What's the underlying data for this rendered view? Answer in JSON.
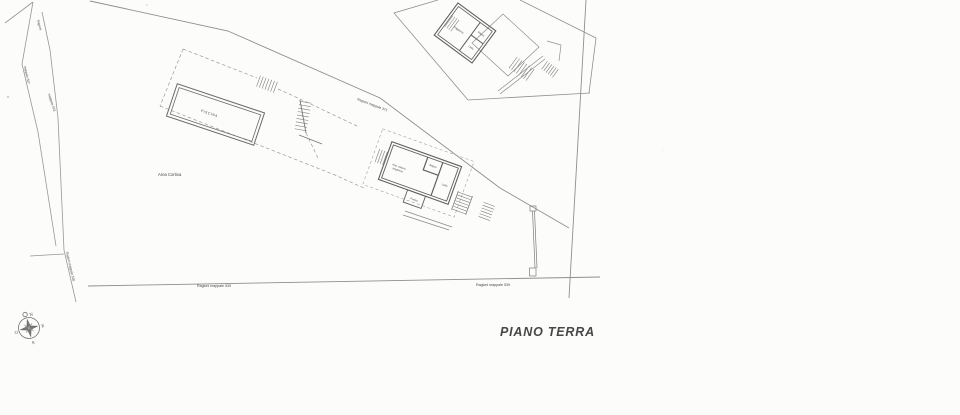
{
  "page": {
    "background": "#fcfcfb",
    "boundary_line_color": "#8f8f8f",
    "wall_color": "#5f5f5f",
    "text_color": "#474747",
    "title_color": "#2e2e2e"
  },
  "title": "PIANO TERRA",
  "parcel_labels": {
    "area_cortiva": "Area Cortiva",
    "mappale_371": "Ragioni mappale 371",
    "mappale_539_left": "Ragioni mappale 539",
    "mappale_539_right": "Ragioni mappale 539",
    "mappale_538": "Ragioni mappale 538",
    "ragioni_strip": "Ragioni",
    "mappale_537": "mappale 537",
    "mappale_533": "mappale 533"
  },
  "pool": {
    "label": "PISCINA"
  },
  "building_rooms": {
    "cottura": "Ang. cottura",
    "soggiorno": "soggiorno",
    "bagno": "Bagno",
    "letto": "Letto",
    "portico": "Portico"
  },
  "inset_rooms": {
    "room_a": "Soggiorno",
    "room_b": "Bagno",
    "room_c": "Letto"
  },
  "compass": {
    "n": "N",
    "e": "E",
    "s": "S",
    "o": "O"
  }
}
